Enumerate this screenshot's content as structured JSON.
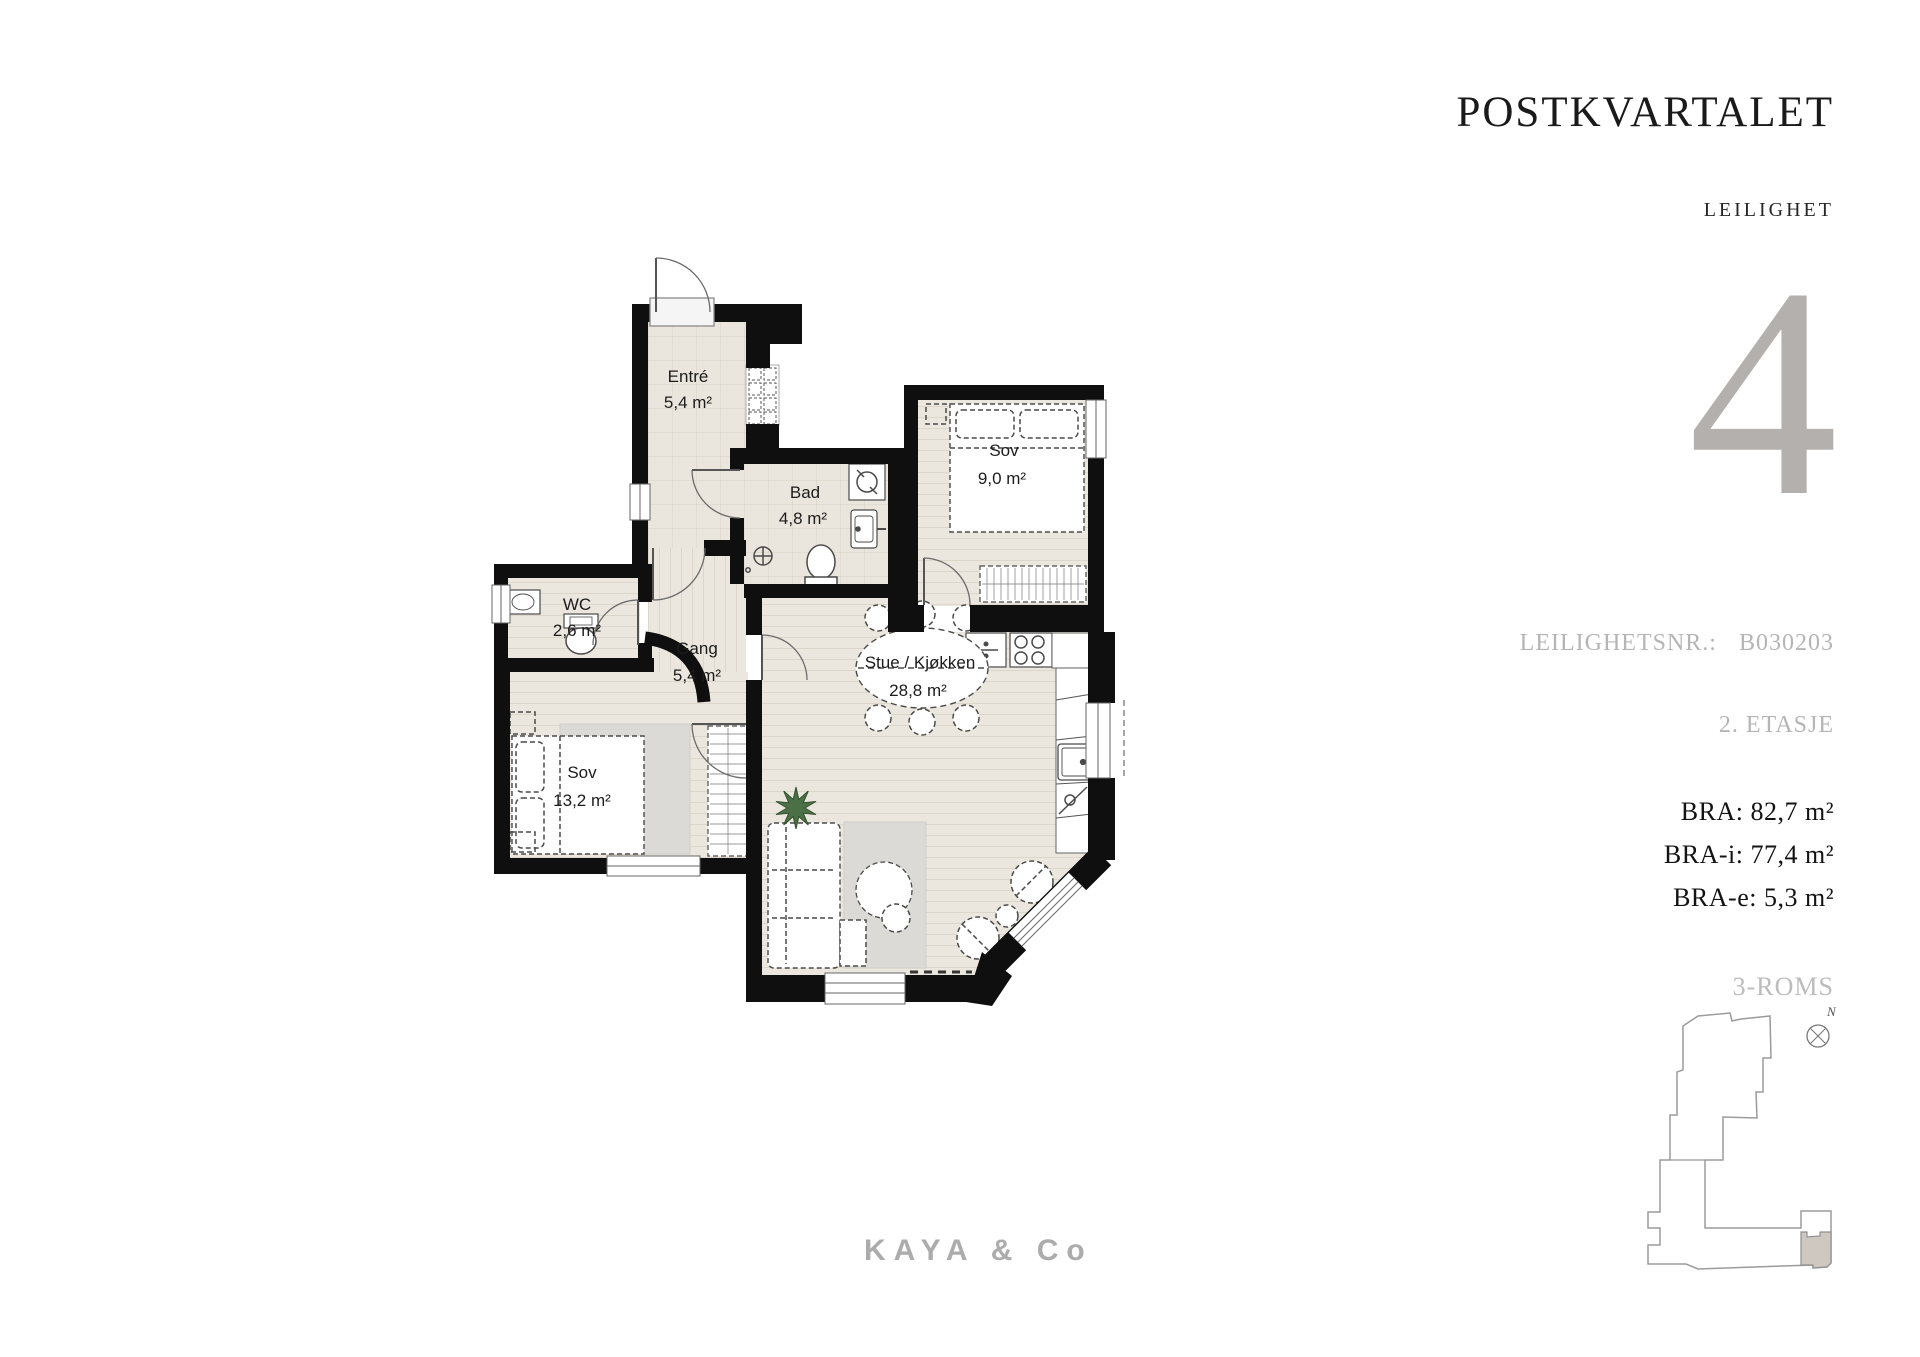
{
  "header": {
    "project": "POSTKVARTALET",
    "subtitle": "LEILIGHET",
    "unit_number": "4"
  },
  "details": {
    "unit_no_label": "LEILIGHETSNR.:",
    "unit_no_value": "B030203",
    "floor_label": "2. ETASJE",
    "bra": "BRA: 82,7 m²",
    "bra_i": "BRA-i: 77,4 m²",
    "bra_e": "BRA-e: 5,3 m²",
    "rooms_label": "3-ROMS"
  },
  "rooms": [
    {
      "name": "Entré",
      "area": "5,4 m²"
    },
    {
      "name": "Bad",
      "area": "4,8 m²"
    },
    {
      "name": "Sov",
      "area": "9,0 m²"
    },
    {
      "name": "WC",
      "area": "2,6 m²"
    },
    {
      "name": "Gang",
      "area": "5,4 m²"
    },
    {
      "name": "Stue / Kjøkken",
      "area": "28,8 m²"
    },
    {
      "name": "Sov",
      "area": "13,2 m²"
    }
  ],
  "footer": {
    "brand": "KAYA & Co"
  },
  "locator": {
    "north_label": "N"
  },
  "colors": {
    "wall": "#0f0f0f",
    "tile_floor": "#eae6dd",
    "wood_floor": "#ebe7de",
    "accent_number": "#b3b0ad",
    "muted_text": "#b5b5b5",
    "highlight_unit": "#cfc8c0",
    "plant": "#4c7046",
    "rug": "#dbdad6"
  }
}
